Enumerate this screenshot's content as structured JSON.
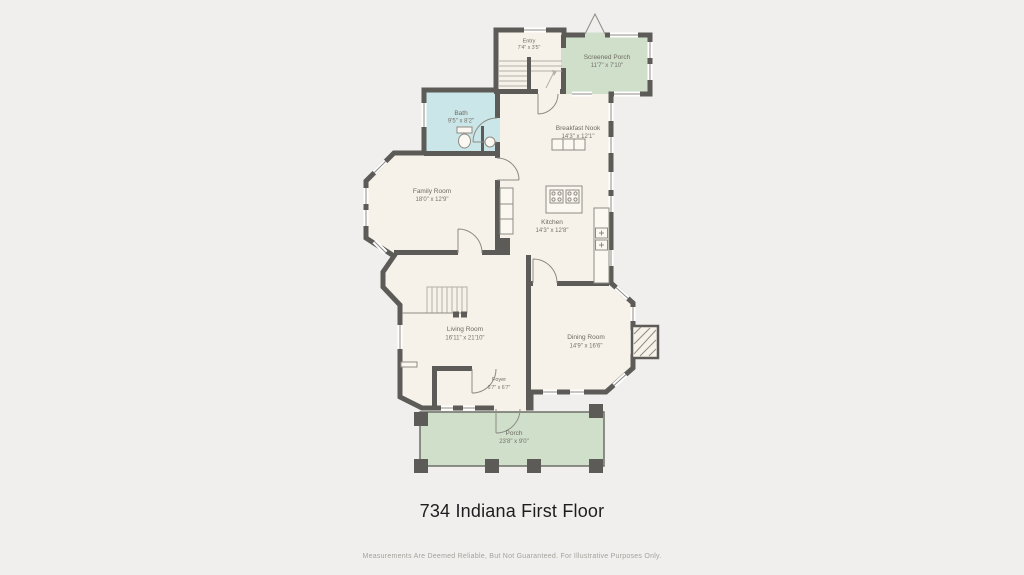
{
  "title": "734 Indiana First Floor",
  "disclaimer": "Measurements Are Deemed Reliable, But Not Guaranteed. For Illustrative Purposes Only.",
  "colors": {
    "background": "#f0efed",
    "wall": "#5c5b58",
    "floor_cream": "#f7f2e9",
    "wet_room_blue": "#cae6e8",
    "porch_green": "#cfdfca",
    "thin_line": "#8f8b84",
    "label_text": "#6e6a60",
    "title_text": "#1d1d1f",
    "disclaimer_text": "#a5a29c"
  },
  "rooms": [
    {
      "id": "entry",
      "name": "Entry",
      "dims": "7'4\" x 3'5\""
    },
    {
      "id": "screened-porch",
      "name": "Screened Porch",
      "dims": "11'7\" x 7'10\""
    },
    {
      "id": "bath",
      "name": "Bath",
      "dims": "9'5\" x 8'2\""
    },
    {
      "id": "breakfast-nook",
      "name": "Breakfast Nook",
      "dims": "14'3\" x 12'1\""
    },
    {
      "id": "family-room",
      "name": "Family Room",
      "dims": "18'0\" x 12'9\""
    },
    {
      "id": "kitchen",
      "name": "Kitchen",
      "dims": "14'3\" x 12'8\""
    },
    {
      "id": "living-room",
      "name": "Living Room",
      "dims": "16'11\" x 21'10\""
    },
    {
      "id": "dining-room",
      "name": "Dining Room",
      "dims": "14'9\" x 16'6\""
    },
    {
      "id": "foyer",
      "name": "Foyer",
      "dims": "6'7\" x 6'7\""
    },
    {
      "id": "porch",
      "name": "Porch",
      "dims": "23'8\" x 9'0\""
    }
  ]
}
